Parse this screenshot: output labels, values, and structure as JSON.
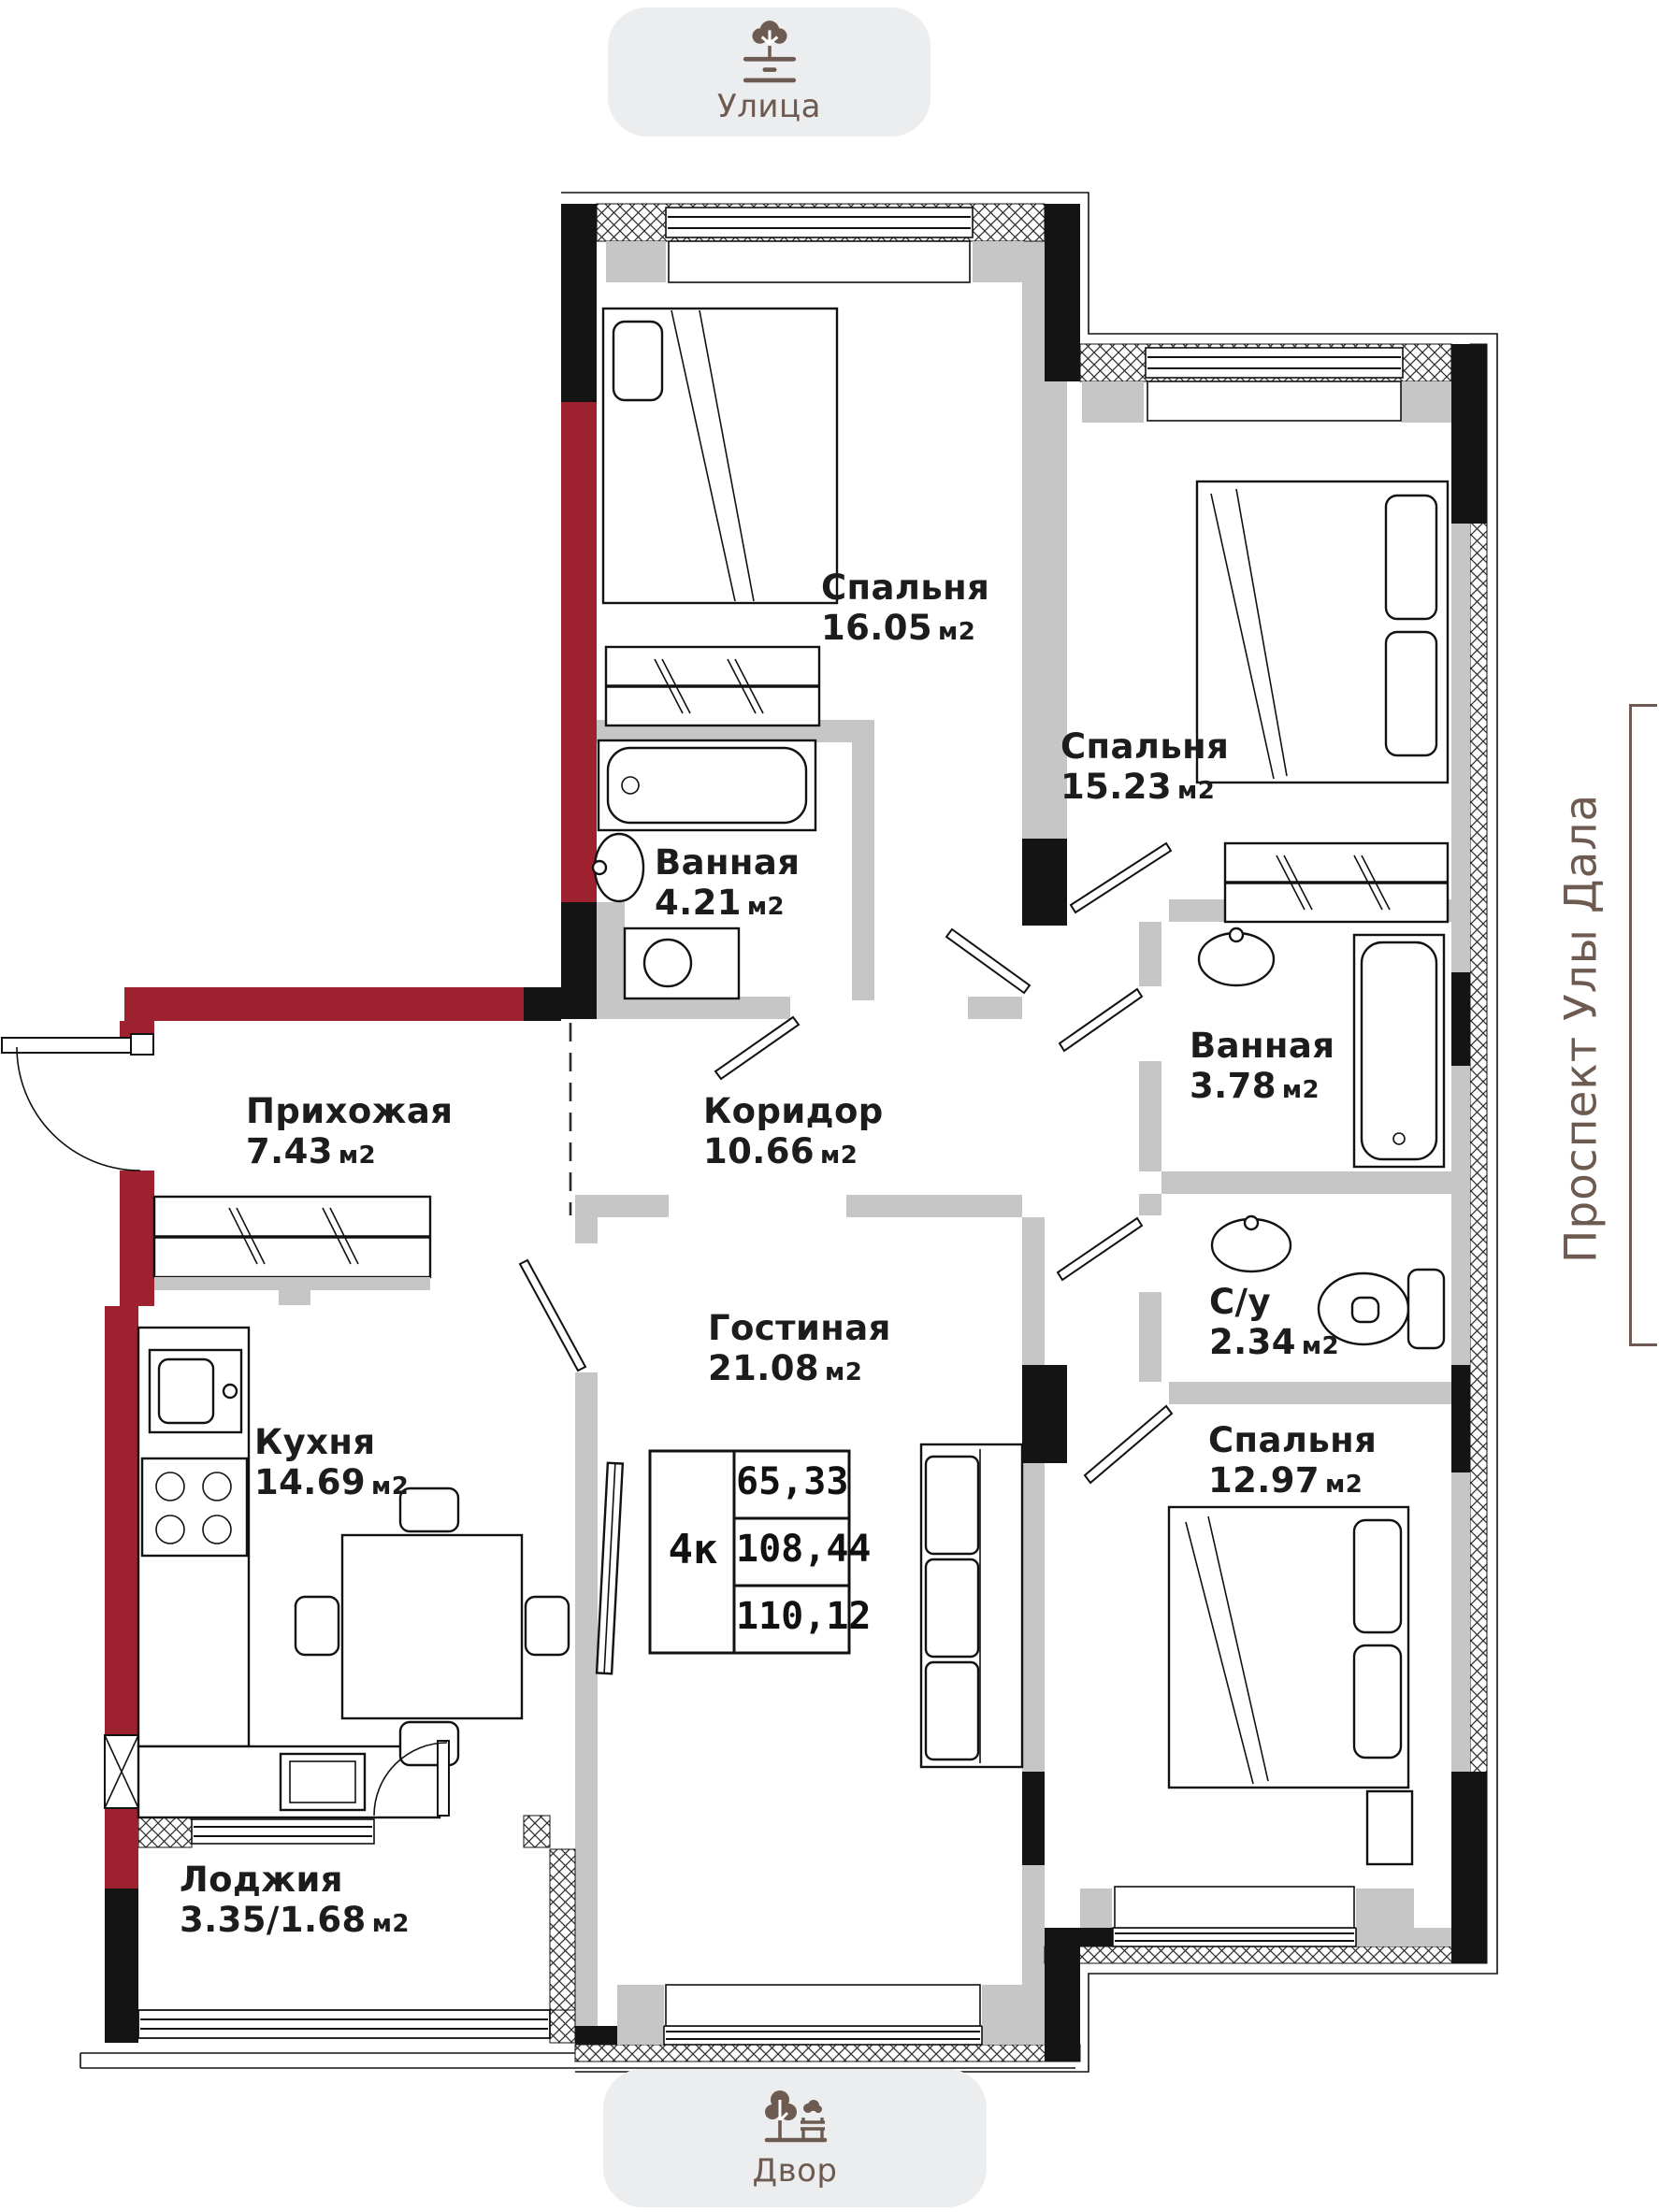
{
  "colors": {
    "wall_red": "#9E2130",
    "wall_black": "#141414",
    "wall_gray": "#C6C6C6",
    "brand_brown": "#6D5A50",
    "badge_bg": "#ECEDEF",
    "text": "#1C1C1C"
  },
  "badges": {
    "street": {
      "label": "Улица",
      "icon": "tree-street-icon"
    },
    "yard": {
      "label": "Двор",
      "icon": "park-bench-icon"
    }
  },
  "street_side": {
    "name": "Проспект Улы Дала"
  },
  "unit_label": "м2",
  "rooms": {
    "bedroom1": {
      "name": "Спальня",
      "area": "16.05"
    },
    "bedroom2": {
      "name": "Спальня",
      "area": "15.23"
    },
    "bath1": {
      "name": "Ванная",
      "area": "4.21"
    },
    "bath2": {
      "name": "Ванная",
      "area": "3.78"
    },
    "hallway": {
      "name": "Прихожая",
      "area": "7.43"
    },
    "corridor": {
      "name": "Коридор",
      "area": "10.66"
    },
    "living": {
      "name": "Гостиная",
      "area": "21.08"
    },
    "kitchen": {
      "name": "Кухня",
      "area": "14.69"
    },
    "wc": {
      "name": "С/у",
      "area": "2.34"
    },
    "bedroom3": {
      "name": "Спальня",
      "area": "12.97"
    },
    "loggia": {
      "name": "Лоджия",
      "area": "3.35/1.68"
    }
  },
  "info_box": {
    "rooms_count": "4к",
    "living_area": "65,33",
    "usable_area": "108,44",
    "total_area": "110,12"
  }
}
